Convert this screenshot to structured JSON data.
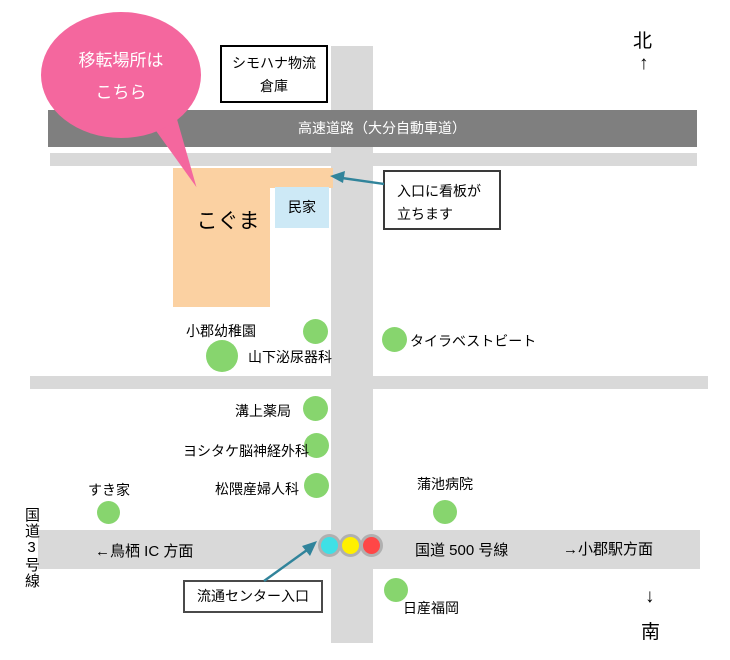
{
  "title_bubble": {
    "line1": "移転場所は",
    "line2": "こちら"
  },
  "warehouse": {
    "line1": "シモハナ物流",
    "line2": "倉庫"
  },
  "expressway": {
    "label": "高速道路（大分自動車道）"
  },
  "koguma": {
    "label": "こぐま"
  },
  "minka": {
    "label": "民家"
  },
  "entrance_callout": {
    "line1": "入口に看板が",
    "line2": "立ちます"
  },
  "ryutsu_center": {
    "label": "流通センター入口"
  },
  "routes": {
    "route3": "国道3号線",
    "tosu_ic": "←鳥栖 IC 方面",
    "route500": "国道 500 号線",
    "ogori_station": "→小郡駅方面"
  },
  "landmarks": [
    "小郡幼稚園",
    "山下泌尿器科",
    "タイラベストビート",
    "溝上薬局",
    "ヨシタケ脳神経外科",
    "松隈産婦人科",
    "すき家",
    "蒲池病院",
    "日産福岡"
  ],
  "compass": {
    "north": "北",
    "north_arrow": "↑",
    "south_arrow": "↓",
    "south": "南"
  },
  "colors": {
    "bubble_pink": "#f4679e",
    "building_orange": "#fbd1a2",
    "minka_blue": "#cde9f6",
    "landmark_green": "#87d56e",
    "expressway_gray": "#7f7f7f",
    "road_gray": "#d9d9d9",
    "arrow_teal": "#31849b",
    "signal_cyan": "#3fe0e6",
    "signal_yellow": "#fff000",
    "signal_red": "#ff4747"
  }
}
